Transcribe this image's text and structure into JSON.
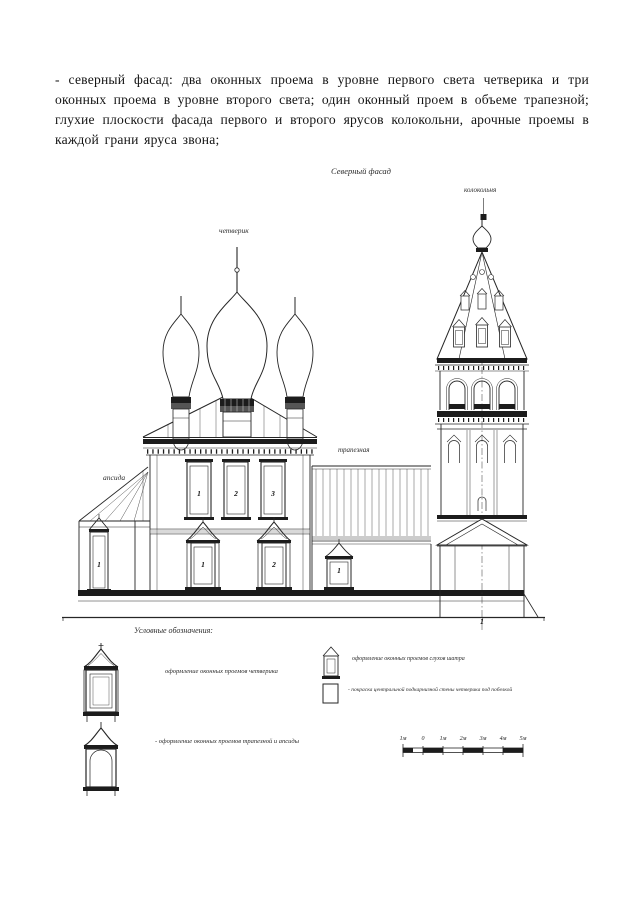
{
  "paragraph": "- северный фасад: два оконных проема в уровне первого света четверика и три оконных проема в уровне второго света; один оконный проем в объеме трапезной; глухие плоскости фасада первого и второго ярусов колокольни, арочные проемы в каждой грани яруса звона;",
  "drawing": {
    "title": "Северный фасад",
    "labels": {
      "bell_tower": "колокольня",
      "chetverik": "четверик",
      "refectory": "трапезная",
      "apse": "апсида"
    },
    "window_numbers": {
      "upper": [
        "1",
        "2",
        "3"
      ],
      "lower": [
        "1",
        "2"
      ],
      "apse": "1",
      "refectory": "1",
      "bell_tower_base": "1"
    }
  },
  "legend": {
    "heading": "Условные обозначения:",
    "items": [
      {
        "icon": "chetverik-window-icon",
        "label": "оформление оконных проемов четверика"
      },
      {
        "icon": "refectory-apse-window-icon",
        "label": "- оформление оконных проемов трапезной и апсиды"
      },
      {
        "icon": "dormer-window-icon",
        "label": "оформление оконных проемов слухов шатра"
      },
      {
        "icon": "plain-square-icon",
        "label": "- покраска центральной подкарнизной стены четверика под побелкой"
      }
    ]
  },
  "scale_bar": {
    "labels": [
      "1м",
      "0",
      "1м",
      "2м",
      "3м",
      "4м",
      "5м"
    ]
  },
  "colors": {
    "ink": "#1c1c1c",
    "paper": "#ffffff"
  }
}
